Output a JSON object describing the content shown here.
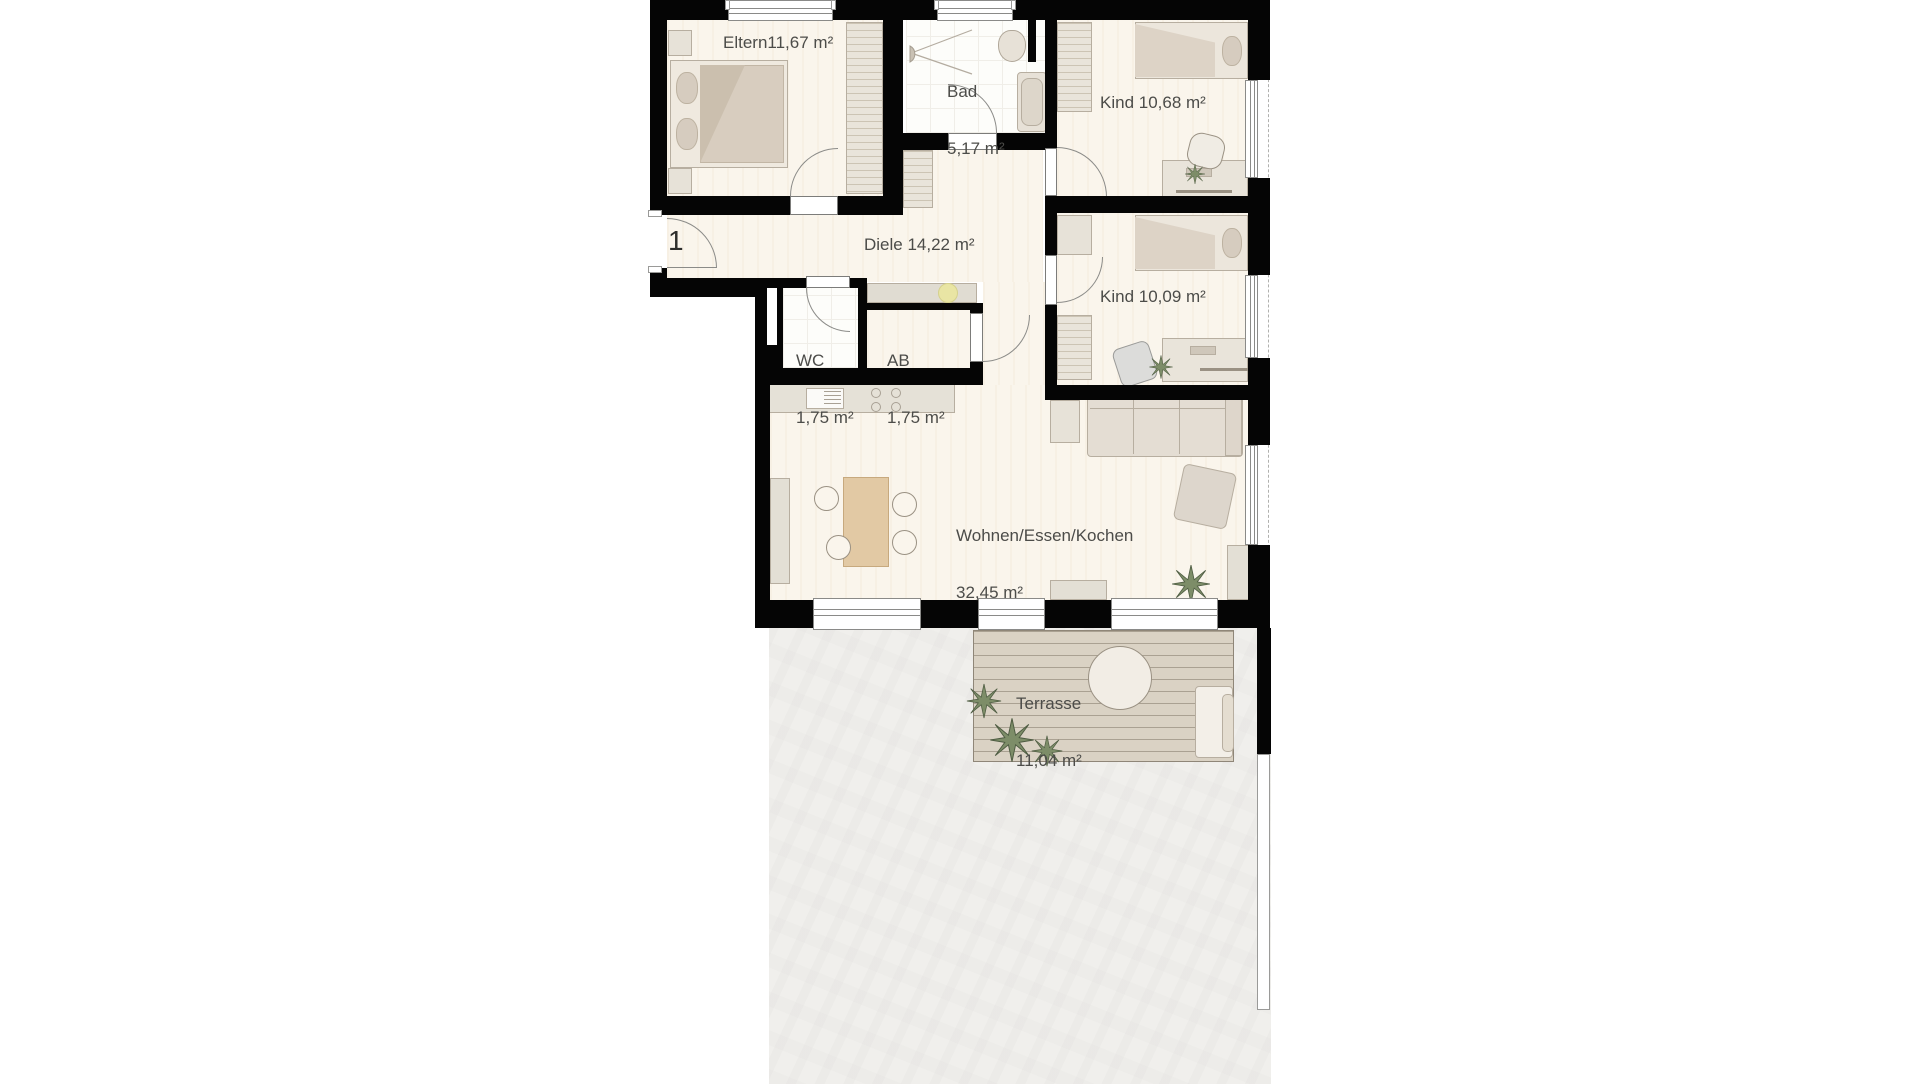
{
  "unit": {
    "number": "1"
  },
  "rooms": {
    "eltern": {
      "label": "Eltern11,67 m²"
    },
    "bad": {
      "name": "Bad",
      "area": "5,17 m²"
    },
    "kind_top": {
      "label": "Kind 10,68 m²"
    },
    "diele": {
      "label": "Diele 14,22 m²"
    },
    "kind_mid": {
      "label": "Kind 10,09 m²"
    },
    "wc": {
      "name": "WC",
      "area": "1,75 m²"
    },
    "ab": {
      "name": "AB",
      "area": "1,75 m²"
    },
    "wohnen": {
      "name": "Wohnen/Essen/Kochen",
      "area": "32,45 m²"
    },
    "terrasse": {
      "name": "Terrasse",
      "area": "11,04 m²"
    }
  },
  "colors": {
    "wall": "#050505",
    "wood_floor": "#faf5ec",
    "tile_floor": "#fdfdfa",
    "furniture": "#e7e2d8",
    "deck": "#dad2c4",
    "garden": "#f0efec",
    "text": "#4c4c49",
    "accent_yellow": "#e9e5a4",
    "plant_green": "#7d8d68"
  }
}
